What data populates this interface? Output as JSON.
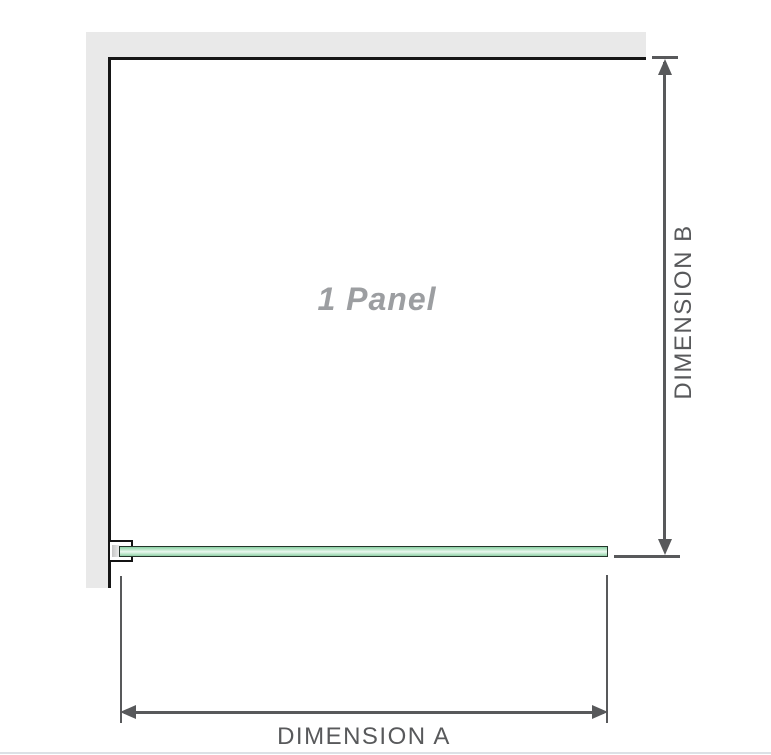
{
  "diagram": {
    "panel_label": "1 Panel",
    "dimension_a": {
      "label": "DIMENSION A",
      "orientation": "horizontal"
    },
    "dimension_b": {
      "label": "DIMENSION B",
      "orientation": "vertical"
    },
    "colors": {
      "wall": "#e9e9e9",
      "panel_outline": "#161616",
      "dimension_lines": "#58595b",
      "panel_label_text": "#9c9ea1",
      "glass_border": "#24342a",
      "glass_green": "#8ad1a4",
      "glass_highlight": "#ecf8f0",
      "bottom_border": "#dce1e6"
    }
  }
}
